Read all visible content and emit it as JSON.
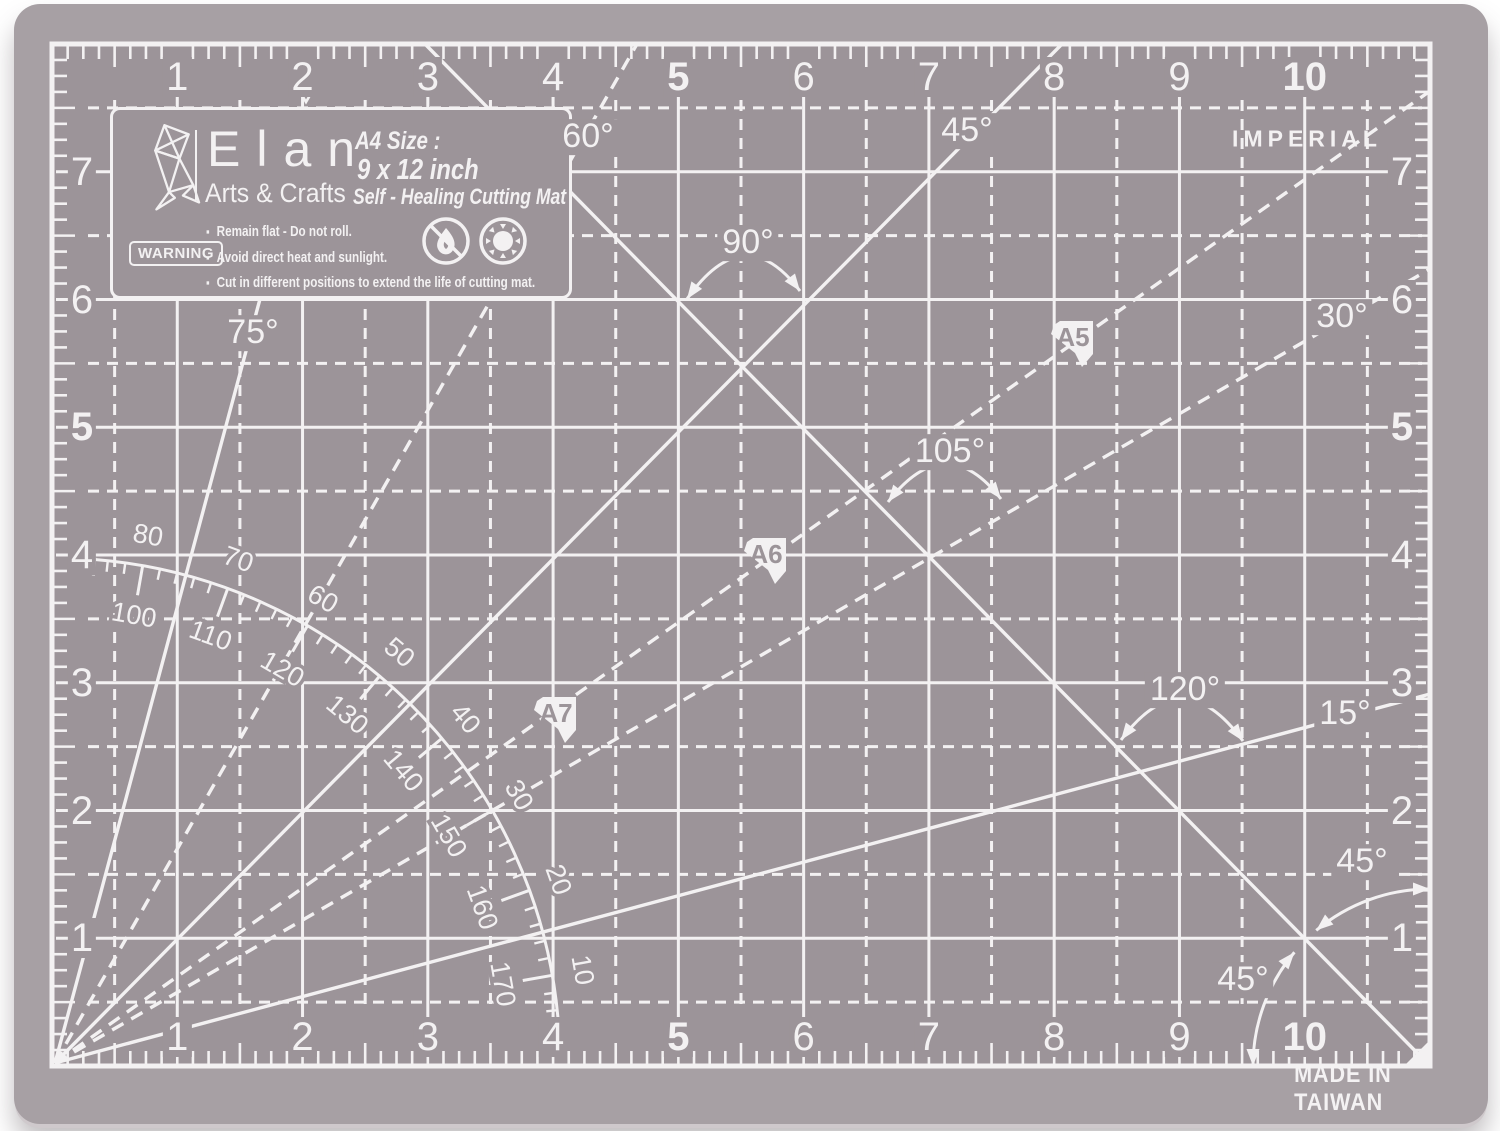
{
  "colors": {
    "surface": "#9c9499",
    "band": "#a7a0a4",
    "ink": "#f3f1f2"
  },
  "brand": {
    "name": "Elan",
    "tagline": "Arts & Crafts",
    "size_title": "A4 Size :",
    "size_value": "9 x 12 inch",
    "product": "Self - Healing Cutting Mat"
  },
  "warning": {
    "box_label": "WARNING",
    "items": [
      "Remain flat - Do not roll.",
      "Avoid direct heat and sunlight.",
      "Cut in different positions to extend the life of cutting mat."
    ]
  },
  "units_label": "IMPERIAL",
  "made_in": "MADE IN TAIWAN",
  "rulers": {
    "top": [
      "1",
      "2",
      "3",
      "4",
      "5",
      "6",
      "7",
      "8",
      "9",
      "10"
    ],
    "bottom": [
      "1",
      "2",
      "3",
      "4",
      "5",
      "6",
      "7",
      "8",
      "9",
      "10"
    ],
    "left": [
      "7",
      "6",
      "5",
      "4",
      "3",
      "2",
      "1"
    ],
    "right": [
      "7",
      "6",
      "5",
      "4",
      "3",
      "2",
      "1"
    ],
    "bold": [
      "5",
      "10"
    ]
  },
  "angle_labels": [
    {
      "text": "60°",
      "x": 588,
      "y": 137
    },
    {
      "text": "45°",
      "x": 967,
      "y": 131
    },
    {
      "text": "90°",
      "x": 748,
      "y": 243
    },
    {
      "text": "75°",
      "x": 253,
      "y": 333
    },
    {
      "text": "30°",
      "x": 1342,
      "y": 317
    },
    {
      "text": "105°",
      "x": 950,
      "y": 452
    },
    {
      "text": "120°",
      "x": 1185,
      "y": 690
    },
    {
      "text": "15°",
      "x": 1345,
      "y": 714
    },
    {
      "text": "45°",
      "x": 1362,
      "y": 862
    },
    {
      "text": "45°",
      "x": 1243,
      "y": 980
    }
  ],
  "paper_markers": [
    {
      "label": "A5",
      "x": 1051,
      "y": 321
    },
    {
      "label": "A6",
      "x": 744,
      "y": 538
    },
    {
      "label": "A7",
      "x": 534,
      "y": 697
    }
  ],
  "protractor": {
    "outer_labels": [
      "80",
      "70",
      "60",
      "50",
      "40",
      "30",
      "20",
      "10"
    ],
    "outer_angles": [
      80,
      70,
      60,
      50,
      40,
      30,
      20,
      10
    ],
    "inner_labels": [
      "100",
      "110",
      "120",
      "130",
      "140",
      "150",
      "160",
      "170"
    ],
    "inner_angles": [
      80,
      70,
      60,
      50,
      40,
      30,
      20,
      10
    ]
  },
  "geometry": {
    "frame": {
      "x": 52,
      "y": 44,
      "w": 1378,
      "h": 1022,
      "cols": 11,
      "rows": 8
    },
    "origin": [
      55,
      1063
    ],
    "rays": [
      {
        "name": "ray-15deg",
        "to": [
          1430,
          694
        ],
        "dashed": false
      },
      {
        "name": "ray-30deg",
        "to": [
          1430,
          269
        ],
        "dashed": true
      },
      {
        "name": "ray-45deg",
        "to": [
          1062,
          44
        ],
        "dashed": false
      },
      {
        "name": "ray-60deg",
        "to": [
          637,
          44
        ],
        "dashed": true
      },
      {
        "name": "ray-75deg",
        "to": [
          260,
          299
        ],
        "dashed": false
      },
      {
        "name": "ray-a-series-diagonal",
        "to": [
          1430,
          91
        ],
        "dashed": true
      }
    ],
    "cross_line": [
      425,
      44,
      1430,
      1066
    ],
    "arc_annotations": [
      {
        "name": "arc-90deg",
        "p0": [
          687,
          299
        ],
        "p1": [
          800,
          291
        ],
        "peak": [
          744,
          256
        ]
      },
      {
        "name": "arc-105deg",
        "p0": [
          888,
          502
        ],
        "p1": [
          1001,
          499
        ],
        "peak": [
          945,
          464
        ]
      },
      {
        "name": "arc-120deg",
        "p0": [
          1121,
          740
        ],
        "p1": [
          1243,
          741
        ],
        "peak": [
          1182,
          699
        ]
      }
    ],
    "corner_arc": {
      "c": [
        1430,
        1066
      ],
      "r": 177,
      "segments": [
        [
          90,
          130
        ],
        [
          140,
          180
        ]
      ]
    },
    "protractor_geo": {
      "r_arc": 505,
      "a0": 5,
      "a1": 85.5,
      "r_out": 527,
      "r_in": 446,
      "tick": 11,
      "tick10": 30
    },
    "marker_path": "M9 0 L42 0 L42 33 L31 46 L24 32 L0 13 L3 4 Z",
    "v_mark": [
      306,
      90
    ],
    "corner_triangle": "1430,1040 1430,1066 1404,1066"
  }
}
